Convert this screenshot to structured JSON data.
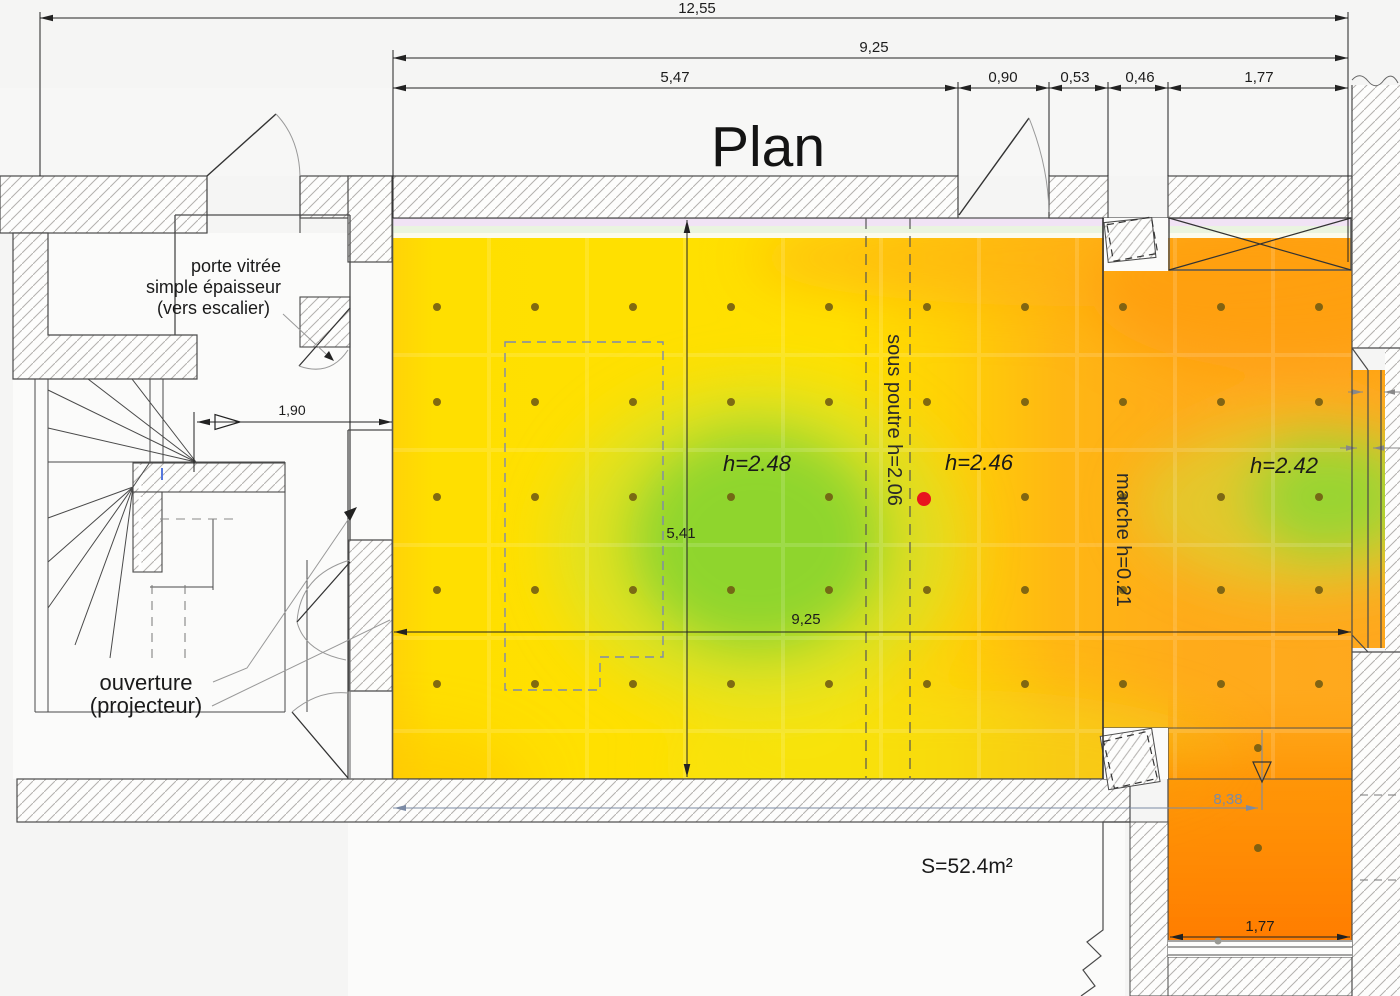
{
  "title": "Plan",
  "dimensions": {
    "overall_width": "12,55",
    "top_width": "9,25",
    "seg1": "5,47",
    "seg2": "0,90",
    "seg3": "0,53",
    "seg4": "0,46",
    "seg5": "1,77",
    "inner_width": "9,25",
    "room_depth": "5,41",
    "corridor": "1,90",
    "offset_line": "8,38",
    "window_width": "1,77"
  },
  "annotations": {
    "glass_door_line1": "porte vitrée",
    "glass_door_line2": "simple épaisseur",
    "glass_door_line3": "(vers escalier)",
    "opening_line1": "ouverture",
    "opening_line2": "(projecteur)",
    "beam": "sous poutre  h=2.06",
    "step": "marche h=0.21",
    "height_center": "h=2.48",
    "height_mid": "h=2.46",
    "height_right": "h=2.42",
    "area": "S=52.4m²"
  },
  "colors": {
    "heat_yellow": "#FFE000",
    "heat_amber": "#FFC80A",
    "heat_orange": "#FFA81E",
    "heat_deep_orange": "#FF7C00",
    "heat_green": "#8CD42E",
    "marker_red": "#E8141E",
    "dashed_zone_blue": "#7D89AD",
    "dim_gray_blue": "#7C8BA5"
  },
  "measurement_grid": {
    "cols": [
      437,
      535,
      633,
      731,
      829,
      927,
      1025,
      1123,
      1221,
      1319
    ],
    "rows": [
      307,
      402,
      497,
      590,
      684
    ],
    "skip": [
      [
        927,
        497
      ]
    ],
    "extra": [
      [
        1258,
        748
      ],
      [
        1258,
        848
      ]
    ],
    "dot_color": "#6f5a12"
  },
  "marker": {
    "x": 924,
    "y": 499,
    "r": 7,
    "color": "#e8141e"
  }
}
